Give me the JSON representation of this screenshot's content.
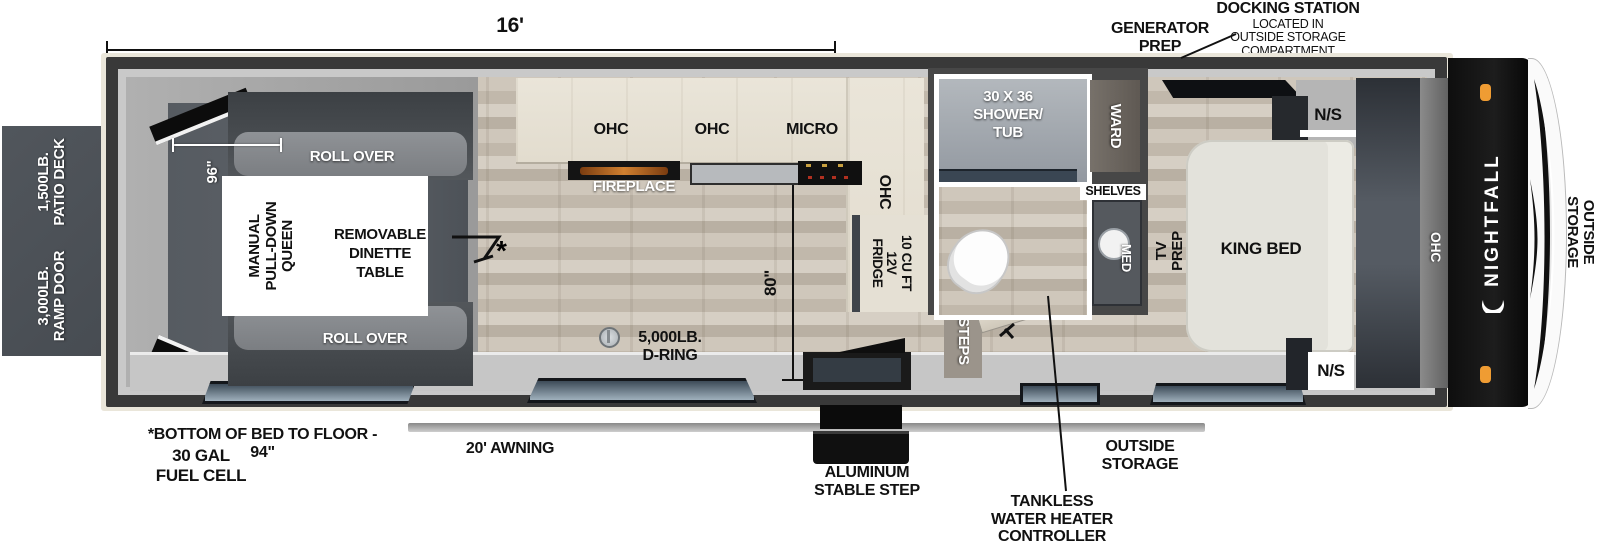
{
  "title": "Nightfall toy hauler floor plan",
  "colors": {
    "wall": "#393939",
    "floor_wood": "#c9c1b5",
    "walkway": "#c6c6c6",
    "garage_dark": "#585d63",
    "sofa": "#85888c",
    "counter": "#e7e2d6",
    "window_glass": "#54616e",
    "marker_light_orange": "#ef9c33",
    "cap_black": "#141414"
  },
  "dimensions": {
    "overall_length": "16'",
    "garage_width": "96\"",
    "kitchen_depth": "80\"",
    "bed_note": "*BOTTOM OF BED TO FLOOR - 94\"",
    "asterisk": "*"
  },
  "exterior": {
    "patio_deck": [
      "1,500LB.",
      "PATIO DECK"
    ],
    "ramp_door": [
      "3,000LB.",
      "RAMP DOOR"
    ],
    "generator_prep": [
      "GENERATOR",
      "PREP"
    ],
    "docking_station_title": "DOCKING STATION",
    "docking_station_lines": [
      "LOCATED IN",
      "OUTSIDE STORAGE",
      "COMPARTMENT"
    ],
    "awning": "20' AWNING",
    "fuel_cell": [
      "30 GAL",
      "FUEL CELL"
    ],
    "stable_step": [
      "ALUMINUM",
      "STABLE STEP"
    ],
    "outside_storage_bottom": [
      "OUTSIDE",
      "STORAGE"
    ],
    "tankless": [
      "TANKLESS",
      "WATER HEATER",
      "CONTROLLER"
    ],
    "outside_storage_right": [
      "OUTSIDE",
      "STORAGE"
    ],
    "brand": "NIGHTFALL"
  },
  "garage": {
    "roll_over_top": "ROLL OVER",
    "roll_over_bottom": "ROLL OVER",
    "queen_bed": [
      "MANUAL",
      "PULL-DOWN",
      "QUEEN"
    ],
    "dinette": [
      "REMOVABLE",
      "DINETTE",
      "TABLE"
    ],
    "d_ring": [
      "5,000LB.",
      "D-RING"
    ]
  },
  "kitchen": {
    "ohc_left": "OHC",
    "ohc_mid": "OHC",
    "micro": "MICRO",
    "fireplace": "FIREPLACE",
    "ohc_right": "OHC",
    "fridge": [
      "10 CU FT",
      "12V",
      "FRIDGE"
    ]
  },
  "bath": {
    "shower": [
      "30 X 36",
      "SHOWER/",
      "TUB"
    ],
    "shelves": "SHELVES",
    "med": "MED",
    "ward": "WARD",
    "steps": "STEPS"
  },
  "bedroom": {
    "king_bed": "KING BED",
    "tv_prep": "TV PREP",
    "ns_top": "N/S",
    "ns_bottom": "N/S",
    "ohc": "OHC"
  }
}
